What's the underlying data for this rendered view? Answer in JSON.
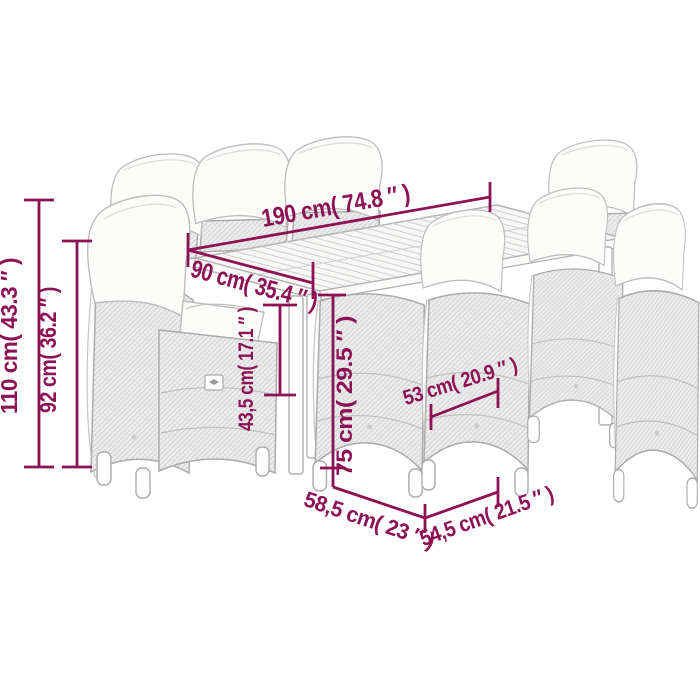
{
  "page": {
    "background": "#ffffff",
    "description": "garden bar set dimension diagram"
  },
  "colors": {
    "dimension_accent": "#8d1155",
    "furniture_outline": "#ababab",
    "wicker_base": "#eeeeee",
    "wicker_weave": "#d3d3d3",
    "cushion_white": "#fcfcfa",
    "table_top": "#f7f7f6"
  },
  "labels": {
    "d190": "190 cm( 74.8 ″ )",
    "d90": "90 cm( 35.4 ″ )",
    "d110": "110 cm( 43.3 ″ )",
    "d92": "92 cm( 36.2 ″ )",
    "d43_5": "43,5 cm( 17.1 ″ )",
    "d75": "75 cm( 29.5 ″ )",
    "d53": "53 cm( 20.9 ″ )",
    "d58_5": "58,5 cm( 23 ″ )",
    "d54_5": "54,5 cm( 21.5 ″ )"
  }
}
